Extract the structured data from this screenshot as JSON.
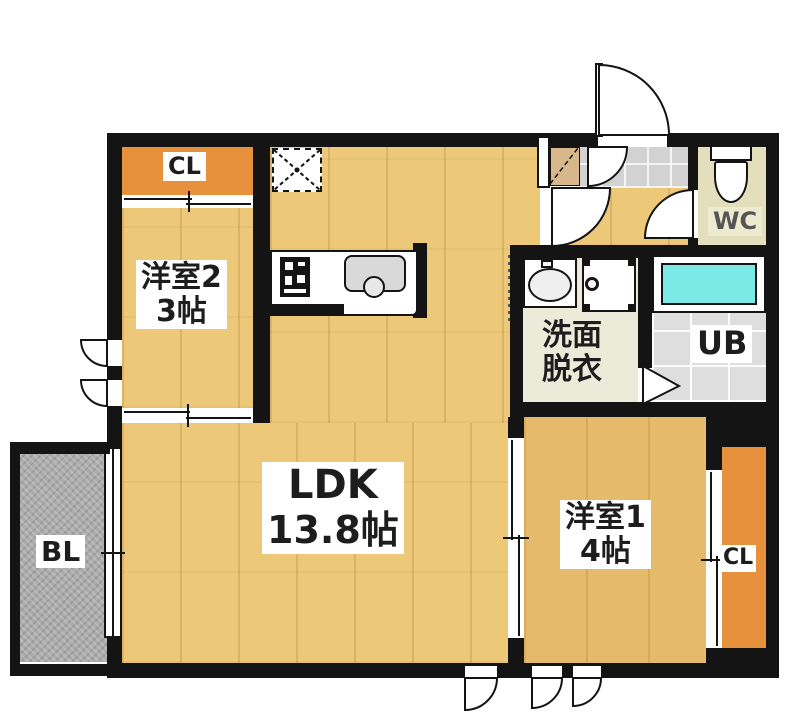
{
  "plan_title": "1LDK apartment floor plan",
  "rooms": {
    "ldk": {
      "name": "LDK",
      "size": "13.8帖",
      "floor_color": "#ECC878"
    },
    "bedroom2": {
      "name": "洋室2",
      "size": "3帖",
      "floor_color": "#ECC878"
    },
    "bedroom1": {
      "name": "洋室1",
      "size": "4帖",
      "floor_color": "#E5BB6B"
    },
    "washroom": {
      "name_line1": "洗面",
      "name_line2": "脱衣",
      "floor_color": "#ECEBDA"
    },
    "unit_bath": {
      "name": "UB",
      "floor_color": "#DEDEDE",
      "bathtub_color": "#7BE9E6"
    },
    "toilet_room": {
      "name": "WC",
      "floor_color": "#E3DEBB"
    },
    "balcony": {
      "name": "BL",
      "floor_color": "#ACACAC"
    },
    "closet_bedroom2": {
      "name": "CL",
      "color": "#E8913D"
    },
    "closet_bedroom1": {
      "name": "CL",
      "color": "#E8913D"
    },
    "entrance": {
      "floor_color": "#D2D2D2"
    }
  },
  "colors": {
    "wall": "#141414",
    "background": "#FFFFFF",
    "shoe_cabinet": "#D8B88B"
  },
  "fixtures": [
    "refrigerator-space",
    "gas-stove",
    "kitchen-sink",
    "toilet",
    "washbasin",
    "washing-machine-space",
    "bathtub",
    "shoe-cabinet",
    "folding-door",
    "sliding-doors",
    "swing-doors",
    "awning-windows"
  ]
}
